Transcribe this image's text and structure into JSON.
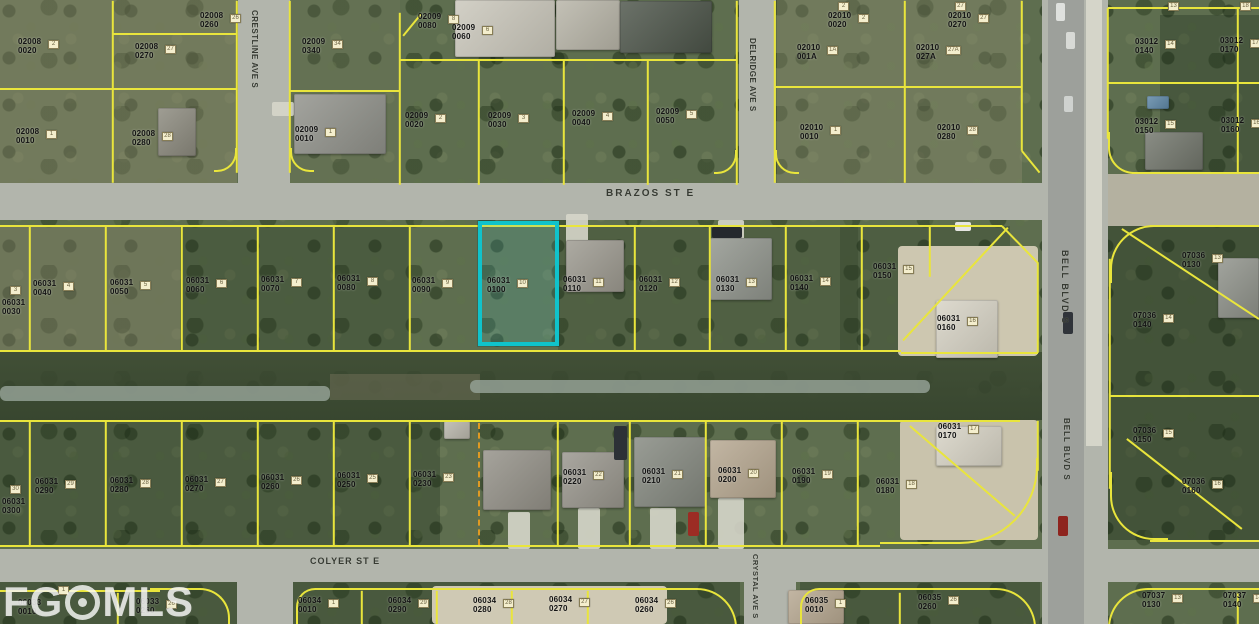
{
  "meta": {
    "width": 1259,
    "height": 624,
    "description": "Aerial parcel map with lot overlays"
  },
  "colors": {
    "parcel_line": "#e9e53c",
    "dashed_line": "#e09a22",
    "highlight": "#10c3cb",
    "road": "#b2b5ac",
    "label": "#141414",
    "dirt": "#cdc7b0",
    "water": "#93a094"
  },
  "watermark": {
    "left": "FG",
    "right": "MLS"
  },
  "highlight": {
    "parcel": "06031 0100",
    "x": 478,
    "y": 221,
    "w": 81,
    "h": 125
  },
  "streets": [
    {
      "t": "BRAZOS ST E",
      "x": 606,
      "y": 188,
      "v": 0,
      "fs": 10,
      "ls": 2
    },
    {
      "t": "CRESTLINE AVE S",
      "x": 250,
      "y": 10,
      "v": 1,
      "fs": 8,
      "ls": 0.5
    },
    {
      "t": "DELRIDGE AVE S",
      "x": 748,
      "y": 38,
      "v": 1,
      "fs": 8,
      "ls": 0.5
    },
    {
      "t": "BELL BLVD S",
      "x": 1060,
      "y": 250,
      "v": 1,
      "fs": 9,
      "ls": 1.5
    },
    {
      "t": "BELL BLVD S",
      "x": 1062,
      "y": 418,
      "v": 1,
      "fs": 8,
      "ls": 1
    },
    {
      "t": "COLYER ST E",
      "x": 310,
      "y": 556,
      "v": 0,
      "fs": 9,
      "ls": 1
    },
    {
      "t": "CRYSTAL AVE S",
      "x": 751,
      "y": 554,
      "v": 1,
      "fs": 7.5,
      "ls": 0.5
    }
  ],
  "parcels": [
    {
      "b": "02008",
      "l": "0020",
      "t": "2",
      "x": 18,
      "y": 38
    },
    {
      "b": "02008",
      "l": "0270",
      "t": "27",
      "x": 135,
      "y": 43
    },
    {
      "b": "02008",
      "l": "0260",
      "t": "26",
      "x": 200,
      "y": 12
    },
    {
      "b": "02008",
      "l": "0010",
      "t": "1",
      "x": 16,
      "y": 128
    },
    {
      "b": "02008",
      "l": "0280",
      "t": "28",
      "x": 132,
      "y": 130
    },
    {
      "b": "02009",
      "l": "0340",
      "t": "34",
      "x": 302,
      "y": 38
    },
    {
      "b": "02009",
      "l": "0010",
      "t": "1",
      "x": 295,
      "y": 126
    },
    {
      "b": "02009",
      "l": "0080",
      "t": "8",
      "x": 418,
      "y": 13
    },
    {
      "b": "02009",
      "l": "0060",
      "t": "6",
      "x": 452,
      "y": 24
    },
    {
      "b": "02009",
      "l": "0020",
      "t": "2",
      "x": 405,
      "y": 112
    },
    {
      "b": "02009",
      "l": "0030",
      "t": "3",
      "x": 488,
      "y": 112
    },
    {
      "b": "02009",
      "l": "0040",
      "t": "4",
      "x": 572,
      "y": 110
    },
    {
      "b": "02009",
      "l": "0050",
      "t": "5",
      "x": 656,
      "y": 108
    },
    {
      "b": "02010",
      "l": "001A",
      "t": "1A",
      "x": 797,
      "y": 44
    },
    {
      "b": "02010",
      "l": "0010",
      "t": "1",
      "x": 800,
      "y": 124
    },
    {
      "b": "02010",
      "l": "0020",
      "t": "2",
      "x": 828,
      "y": 12
    },
    {
      "b": "02010",
      "l": "027A",
      "t": "27A",
      "x": 916,
      "y": 44
    },
    {
      "b": "02010",
      "l": "0270",
      "t": "27",
      "x": 948,
      "y": 12
    },
    {
      "b": "02010",
      "l": "0280",
      "t": "28",
      "x": 937,
      "y": 124
    },
    {
      "b": "03012",
      "l": "0140",
      "t": "14",
      "x": 1135,
      "y": 38
    },
    {
      "b": "03012",
      "l": "0170",
      "t": "17",
      "x": 1220,
      "y": 37
    },
    {
      "b": "03012",
      "l": "0150",
      "t": "15",
      "x": 1135,
      "y": 118
    },
    {
      "b": "03012",
      "l": "0160",
      "t": "16",
      "x": 1221,
      "y": 117
    },
    {
      "b": "06031",
      "l": "0030",
      "t": "3",
      "x": 2,
      "y": 299,
      "tdx": 8,
      "tdy": -13
    },
    {
      "b": "06031",
      "l": "0040",
      "t": "4",
      "x": 33,
      "y": 280
    },
    {
      "b": "06031",
      "l": "0050",
      "t": "5",
      "x": 110,
      "y": 279
    },
    {
      "b": "06031",
      "l": "0060",
      "t": "6",
      "x": 186,
      "y": 277
    },
    {
      "b": "06031",
      "l": "0070",
      "t": "7",
      "x": 261,
      "y": 276
    },
    {
      "b": "06031",
      "l": "0080",
      "t": "8",
      "x": 337,
      "y": 275
    },
    {
      "b": "06031",
      "l": "0090",
      "t": "9",
      "x": 412,
      "y": 277
    },
    {
      "b": "06031",
      "l": "0100",
      "t": "10",
      "x": 487,
      "y": 277
    },
    {
      "b": "06031",
      "l": "0110",
      "t": "11",
      "x": 563,
      "y": 276
    },
    {
      "b": "06031",
      "l": "0120",
      "t": "12",
      "x": 639,
      "y": 276
    },
    {
      "b": "06031",
      "l": "0130",
      "t": "13",
      "x": 716,
      "y": 276
    },
    {
      "b": "06031",
      "l": "0140",
      "t": "14",
      "x": 790,
      "y": 275
    },
    {
      "b": "06031",
      "l": "0150",
      "t": "15",
      "x": 873,
      "y": 263
    },
    {
      "b": "06031",
      "l": "0160",
      "t": "16",
      "x": 937,
      "y": 315
    },
    {
      "b": "06031",
      "l": "0300",
      "t": "30",
      "x": 2,
      "y": 498,
      "tdx": 8,
      "tdy": -13
    },
    {
      "b": "06031",
      "l": "0290",
      "t": "29",
      "x": 35,
      "y": 478
    },
    {
      "b": "06031",
      "l": "0280",
      "t": "28",
      "x": 110,
      "y": 477
    },
    {
      "b": "06031",
      "l": "0270",
      "t": "27",
      "x": 185,
      "y": 476
    },
    {
      "b": "06031",
      "l": "0260",
      "t": "26",
      "x": 261,
      "y": 474
    },
    {
      "b": "06031",
      "l": "0250",
      "t": "25",
      "x": 337,
      "y": 472
    },
    {
      "b": "06031",
      "l": "0230",
      "t": "23",
      "x": 413,
      "y": 471
    },
    {
      "b": "06031",
      "l": "0220",
      "t": "22",
      "x": 563,
      "y": 469
    },
    {
      "b": "06031",
      "l": "0210",
      "t": "21",
      "x": 642,
      "y": 468
    },
    {
      "b": "06031",
      "l": "0200",
      "t": "20",
      "x": 718,
      "y": 467
    },
    {
      "b": "06031",
      "l": "0190",
      "t": "19",
      "x": 792,
      "y": 468
    },
    {
      "b": "06031",
      "l": "0180",
      "t": "18",
      "x": 876,
      "y": 478
    },
    {
      "b": "06031",
      "l": "0170",
      "t": "17",
      "x": 938,
      "y": 423
    },
    {
      "b": "07036",
      "l": "0130",
      "t": "13",
      "x": 1182,
      "y": 252
    },
    {
      "b": "07036",
      "l": "0140",
      "t": "14",
      "x": 1133,
      "y": 312
    },
    {
      "b": "07036",
      "l": "0150",
      "t": "15",
      "x": 1133,
      "y": 427
    },
    {
      "b": "07036",
      "l": "0160",
      "t": "16",
      "x": 1182,
      "y": 478
    },
    {
      "b": "06033",
      "l": "0010",
      "t": "1",
      "x": 18,
      "y": 599,
      "tdx": 40,
      "tdy": -13
    },
    {
      "b": "06033",
      "l": "0260",
      "t": "26",
      "x": 136,
      "y": 598
    },
    {
      "b": "06034",
      "l": "0010",
      "t": "1",
      "x": 298,
      "y": 597
    },
    {
      "b": "06034",
      "l": "0290",
      "t": "29",
      "x": 388,
      "y": 597
    },
    {
      "b": "06034",
      "l": "0280",
      "t": "28",
      "x": 473,
      "y": 597
    },
    {
      "b": "06034",
      "l": "0270",
      "t": "27",
      "x": 549,
      "y": 596
    },
    {
      "b": "06034",
      "l": "0260",
      "t": "26",
      "x": 635,
      "y": 597
    },
    {
      "b": "06035",
      "l": "0010",
      "t": "1",
      "x": 805,
      "y": 597
    },
    {
      "b": "06035",
      "l": "0260",
      "t": "26",
      "x": 918,
      "y": 594
    },
    {
      "b": "07037",
      "l": "0130",
      "t": "13",
      "x": 1142,
      "y": 592
    },
    {
      "b": "07037",
      "l": "0140",
      "t": "14",
      "x": 1223,
      "y": 592
    }
  ],
  "standalone_tags": [
    {
      "t": "2",
      "x": 838,
      "y": 2
    },
    {
      "t": "27",
      "x": 955,
      "y": 2
    },
    {
      "t": "13",
      "x": 1168,
      "y": 2
    },
    {
      "t": "18",
      "x": 1240,
      "y": 2
    }
  ],
  "roads": [
    {
      "n": "brazos-st-e",
      "x": 0,
      "y": 183,
      "w": 1046,
      "h": 37
    },
    {
      "n": "colyer-st-e",
      "x": 0,
      "y": 549,
      "w": 1259,
      "h": 33
    },
    {
      "n": "crestline-ave-s",
      "x": 238,
      "y": 0,
      "w": 52,
      "h": 190
    },
    {
      "n": "delridge-ave-s",
      "x": 739,
      "y": 0,
      "w": 37,
      "h": 190
    },
    {
      "n": "bell-blvd-s",
      "x": 1042,
      "y": 0,
      "w": 66,
      "h": 624
    },
    {
      "n": "bell-asphalt",
      "x": 1048,
      "y": 0,
      "w": 36,
      "h": 624,
      "c": "#9da09b"
    },
    {
      "n": "bell-path",
      "x": 1086,
      "y": 0,
      "w": 16,
      "h": 446,
      "c": "#d5d5c9"
    },
    {
      "n": "crystal-ave-s",
      "x": 744,
      "y": 582,
      "w": 52,
      "h": 42
    },
    {
      "n": "west-ave",
      "x": 237,
      "y": 582,
      "w": 56,
      "h": 42
    },
    {
      "n": "bell-shoulder",
      "x": 1108,
      "y": 174,
      "w": 151,
      "h": 52,
      "c": "#b4b1a0"
    }
  ],
  "canal": {
    "band": {
      "x": 0,
      "y": 352,
      "w": 1042,
      "h": 68
    },
    "bare": {
      "x": 330,
      "y": 374,
      "w": 150,
      "h": 26
    },
    "water": [
      {
        "x": 0,
        "y": 386,
        "w": 330,
        "h": 15
      },
      {
        "x": 470,
        "y": 380,
        "w": 460,
        "h": 13
      }
    ]
  },
  "patches": [
    {
      "x": 0,
      "y": 0,
      "w": 237,
      "h": 183,
      "c": "rgba(148,143,112,0.38)"
    },
    {
      "x": 290,
      "y": 0,
      "w": 110,
      "h": 183,
      "c": "rgba(120,125,95,0.25)"
    },
    {
      "x": 777,
      "y": 0,
      "w": 245,
      "h": 183,
      "c": "rgba(150,146,118,0.35)"
    },
    {
      "x": 0,
      "y": 226,
      "w": 180,
      "h": 124,
      "c": "rgba(135,130,105,0.40)"
    },
    {
      "x": 180,
      "y": 226,
      "w": 230,
      "h": 124,
      "c": "rgba(28,45,24,0.28)"
    },
    {
      "x": 558,
      "y": 226,
      "w": 300,
      "h": 124,
      "c": "rgba(30,48,26,0.22)"
    },
    {
      "x": 840,
      "y": 226,
      "w": 170,
      "h": 124,
      "c": "rgba(30,48,26,0.25)"
    },
    {
      "x": 0,
      "y": 420,
      "w": 440,
      "h": 125,
      "c": "rgba(30,48,26,0.30)"
    },
    {
      "x": 1108,
      "y": 225,
      "w": 151,
      "h": 315,
      "c": "rgba(24,40,22,0.38)"
    },
    {
      "x": 1160,
      "y": 15,
      "w": 99,
      "h": 160,
      "c": "rgba(24,40,22,0.30)"
    },
    {
      "x": 0,
      "y": 582,
      "w": 740,
      "h": 42,
      "c": "rgba(26,42,23,0.30)"
    },
    {
      "x": 800,
      "y": 582,
      "w": 240,
      "h": 42,
      "c": "rgba(26,42,23,0.30)"
    }
  ],
  "dirt": [
    {
      "x": 898,
      "y": 246,
      "w": 140,
      "h": 110,
      "c": "#cdc7b0"
    },
    {
      "x": 900,
      "y": 420,
      "w": 138,
      "h": 120,
      "c": "#c9c3ac"
    },
    {
      "x": 432,
      "y": 586,
      "w": 235,
      "h": 38,
      "c": "#cfc9b4"
    }
  ],
  "aprons": [
    {
      "x": 566,
      "y": 214,
      "w": 22,
      "h": 34
    },
    {
      "x": 718,
      "y": 220,
      "w": 26,
      "h": 26
    },
    {
      "x": 272,
      "y": 102,
      "w": 22,
      "h": 14
    },
    {
      "x": 508,
      "y": 512,
      "w": 22,
      "h": 37
    },
    {
      "x": 578,
      "y": 508,
      "w": 22,
      "h": 41
    },
    {
      "x": 650,
      "y": 508,
      "w": 26,
      "h": 41
    },
    {
      "x": 718,
      "y": 498,
      "w": 26,
      "h": 51
    }
  ],
  "houses": [
    {
      "x": 294,
      "y": 94,
      "w": 92,
      "h": 60,
      "c": "#8f9089"
    },
    {
      "x": 158,
      "y": 108,
      "w": 38,
      "h": 48,
      "c": "#8a887c"
    },
    {
      "x": 455,
      "y": 0,
      "w": 100,
      "h": 57,
      "c": "#c9c6ba"
    },
    {
      "x": 556,
      "y": 0,
      "w": 64,
      "h": 50,
      "c": "#b6b3a6"
    },
    {
      "x": 620,
      "y": 1,
      "w": 92,
      "h": 52,
      "c": "#4b5348"
    },
    {
      "x": 566,
      "y": 240,
      "w": 58,
      "h": 52,
      "c": "#9b988e"
    },
    {
      "x": 710,
      "y": 238,
      "w": 62,
      "h": 62,
      "c": "#8f938b"
    },
    {
      "x": 936,
      "y": 300,
      "w": 62,
      "h": 58,
      "c": "#d6d2c4"
    },
    {
      "x": 483,
      "y": 450,
      "w": 68,
      "h": 60,
      "c": "#928f86"
    },
    {
      "x": 562,
      "y": 452,
      "w": 62,
      "h": 56,
      "c": "#97948b"
    },
    {
      "x": 634,
      "y": 437,
      "w": 72,
      "h": 70,
      "c": "#83877e"
    },
    {
      "x": 710,
      "y": 440,
      "w": 66,
      "h": 58,
      "c": "#b5a68f"
    },
    {
      "x": 936,
      "y": 426,
      "w": 66,
      "h": 40,
      "c": "#d6d2c4"
    },
    {
      "x": 1218,
      "y": 258,
      "w": 41,
      "h": 60,
      "c": "#8d9088"
    },
    {
      "x": 1145,
      "y": 132,
      "w": 58,
      "h": 38,
      "c": "#70746a"
    },
    {
      "x": 788,
      "y": 590,
      "w": 56,
      "h": 34,
      "c": "#b5a68f"
    },
    {
      "x": 444,
      "y": 421,
      "w": 26,
      "h": 18,
      "c": "#b8b5aa"
    },
    {
      "x": 1147,
      "y": 96,
      "w": 22,
      "h": 13,
      "c": "#5d86a5"
    }
  ],
  "cars": [
    {
      "x": 688,
      "y": 512,
      "w": 11,
      "h": 24,
      "c": "#9c2c24"
    },
    {
      "x": 614,
      "y": 426,
      "w": 13,
      "h": 34,
      "c": "#2c3136"
    },
    {
      "x": 1063,
      "y": 312,
      "w": 10,
      "h": 22,
      "c": "#30343a"
    },
    {
      "x": 1056,
      "y": 3,
      "w": 9,
      "h": 18,
      "c": "#dfe1de"
    },
    {
      "x": 1066,
      "y": 32,
      "w": 9,
      "h": 17,
      "c": "#d8dad6"
    },
    {
      "x": 1064,
      "y": 96,
      "w": 9,
      "h": 16,
      "c": "#cfd2cf"
    },
    {
      "x": 1058,
      "y": 516,
      "w": 10,
      "h": 20,
      "c": "#8e241e"
    },
    {
      "x": 712,
      "y": 227,
      "w": 30,
      "h": 11,
      "c": "#24282d"
    },
    {
      "x": 955,
      "y": 222,
      "w": 16,
      "h": 9,
      "c": "#e6e6e2"
    }
  ],
  "lines": [
    [
      0,
      88,
      237,
      88
    ],
    [
      113,
      0,
      113,
      182
    ],
    [
      113,
      33,
      237,
      33
    ],
    [
      237,
      0,
      237,
      172
    ],
    [
      290,
      0,
      290,
      172
    ],
    [
      290,
      90,
      400,
      90
    ],
    [
      400,
      12,
      400,
      184
    ],
    [
      400,
      59,
      737,
      59
    ],
    [
      479,
      59,
      479,
      184
    ],
    [
      564,
      59,
      564,
      184
    ],
    [
      648,
      59,
      648,
      184
    ],
    [
      737,
      0,
      737,
      184
    ],
    [
      403,
      35,
      421,
      13
    ],
    [
      775,
      0,
      775,
      182
    ],
    [
      775,
      86,
      1022,
      86
    ],
    [
      905,
      0,
      905,
      182
    ],
    [
      1022,
      0,
      1022,
      150
    ],
    [
      1022,
      150,
      1040,
      172
    ],
    [
      1108,
      7,
      1259,
      7
    ],
    [
      1108,
      7,
      1108,
      138
    ],
    [
      1108,
      82,
      1259,
      82
    ],
    [
      1238,
      7,
      1238,
      172
    ],
    [
      1132,
      172,
      1259,
      172
    ],
    [
      0,
      225,
      1002,
      225
    ],
    [
      0,
      350,
      901,
      350
    ],
    [
      30,
      225,
      30,
      350
    ],
    [
      106,
      225,
      106,
      350
    ],
    [
      182,
      225,
      182,
      350
    ],
    [
      258,
      225,
      258,
      350
    ],
    [
      334,
      225,
      334,
      350
    ],
    [
      410,
      225,
      410,
      350
    ],
    [
      635,
      225,
      635,
      350
    ],
    [
      710,
      225,
      710,
      350
    ],
    [
      786,
      225,
      786,
      350
    ],
    [
      862,
      225,
      862,
      350
    ],
    [
      930,
      225,
      930,
      276
    ],
    [
      1002,
      225,
      1038,
      262
    ],
    [
      1038,
      262,
      1038,
      352
    ],
    [
      901,
      352,
      1038,
      352
    ],
    [
      1008,
      227,
      903,
      340
    ],
    [
      0,
      420,
      1020,
      420
    ],
    [
      0,
      545,
      880,
      545
    ],
    [
      30,
      420,
      30,
      545
    ],
    [
      106,
      420,
      106,
      545
    ],
    [
      182,
      420,
      182,
      545
    ],
    [
      258,
      420,
      258,
      545
    ],
    [
      334,
      420,
      334,
      545
    ],
    [
      410,
      420,
      410,
      545
    ],
    [
      558,
      420,
      558,
      545
    ],
    [
      630,
      420,
      630,
      545
    ],
    [
      706,
      420,
      706,
      545
    ],
    [
      782,
      420,
      782,
      545
    ],
    [
      858,
      420,
      858,
      545
    ],
    [
      910,
      425,
      1015,
      515
    ],
    [
      1038,
      420,
      1038,
      470
    ],
    [
      1150,
      225,
      1259,
      225
    ],
    [
      1110,
      258,
      1110,
      488
    ],
    [
      1122,
      228,
      1259,
      318
    ],
    [
      1110,
      395,
      1259,
      395
    ],
    [
      1127,
      438,
      1242,
      528
    ],
    [
      1150,
      540,
      1259,
      540
    ],
    [
      118,
      592,
      118,
      624
    ],
    [
      362,
      590,
      362,
      624
    ],
    [
      437,
      590,
      437,
      624
    ],
    [
      512,
      590,
      512,
      624
    ],
    [
      588,
      590,
      588,
      624
    ],
    [
      900,
      592,
      900,
      624
    ],
    [
      1238,
      592,
      1238,
      624
    ],
    [
      0,
      590,
      160,
      590
    ]
  ],
  "dashed_lines": [
    {
      "x1": 480,
      "y1": 423,
      "x2": 480,
      "y2": 545
    }
  ],
  "arcs": [
    {
      "x": 1108,
      "y": 132,
      "w": 28,
      "h": 42,
      "bl": 1,
      "bb": 1,
      "rbl": 26
    },
    {
      "x": 150,
      "y": 588,
      "w": 80,
      "h": 36,
      "bt": 1,
      "br": 1,
      "rtr": 30
    },
    {
      "x": 296,
      "y": 588,
      "w": 441,
      "h": 40,
      "bt": 1,
      "bl": 1,
      "br": 1,
      "rtl": 22,
      "rtr": 46
    },
    {
      "x": 800,
      "y": 588,
      "w": 236,
      "h": 40,
      "bt": 1,
      "bl": 1,
      "br": 1,
      "rtl": 22,
      "rtr": 46
    },
    {
      "x": 1108,
      "y": 588,
      "w": 151,
      "h": 40,
      "bt": 1,
      "bl": 1,
      "rtl": 40
    },
    {
      "x": 880,
      "y": 458,
      "w": 158,
      "h": 86,
      "br": 1,
      "bb": 1,
      "rbr": 78
    },
    {
      "x": 1110,
      "y": 225,
      "w": 58,
      "h": 58,
      "bt": 1,
      "bl": 1,
      "rtl": 44
    },
    {
      "x": 1110,
      "y": 472,
      "w": 58,
      "h": 68,
      "bl": 1,
      "bb": 1,
      "rbl": 44
    },
    {
      "x": 214,
      "y": 148,
      "w": 23,
      "h": 24,
      "br": 1,
      "bb": 1,
      "rbr": 20
    },
    {
      "x": 290,
      "y": 148,
      "w": 24,
      "h": 24,
      "bl": 1,
      "bb": 1,
      "rbl": 20
    },
    {
      "x": 714,
      "y": 150,
      "w": 23,
      "h": 24,
      "br": 1,
      "bb": 1,
      "rbr": 20
    },
    {
      "x": 775,
      "y": 150,
      "w": 24,
      "h": 24,
      "bl": 1,
      "bb": 1,
      "rbl": 20
    }
  ]
}
